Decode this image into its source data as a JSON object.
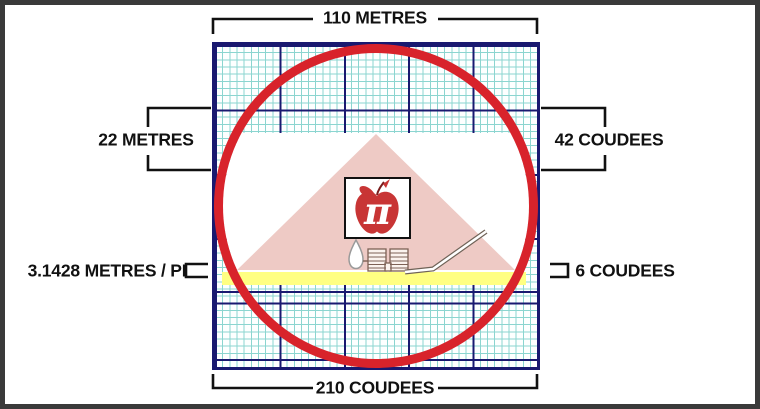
{
  "title": "Pyramid / circle squaring diagram",
  "measurements": {
    "top": "110 METRES",
    "bottom": "210 COUDEES",
    "left_height": "22 METRES",
    "right_height": "42 COUDEES",
    "left_unit": "3.1428 METRES / PI",
    "right_unit": "6 COUDEES"
  },
  "symbol": {
    "pi": "π"
  },
  "colors": {
    "circle": "#d8232b",
    "pyramid": "#eecac5",
    "ground_strip": "#ffff82",
    "apple": "#c83535",
    "apple_box_border": "#111111",
    "grid_major": "#191970",
    "grid_fine": "#8bd5d0",
    "bracket": "#111111",
    "frame": "#3a3a3a"
  }
}
